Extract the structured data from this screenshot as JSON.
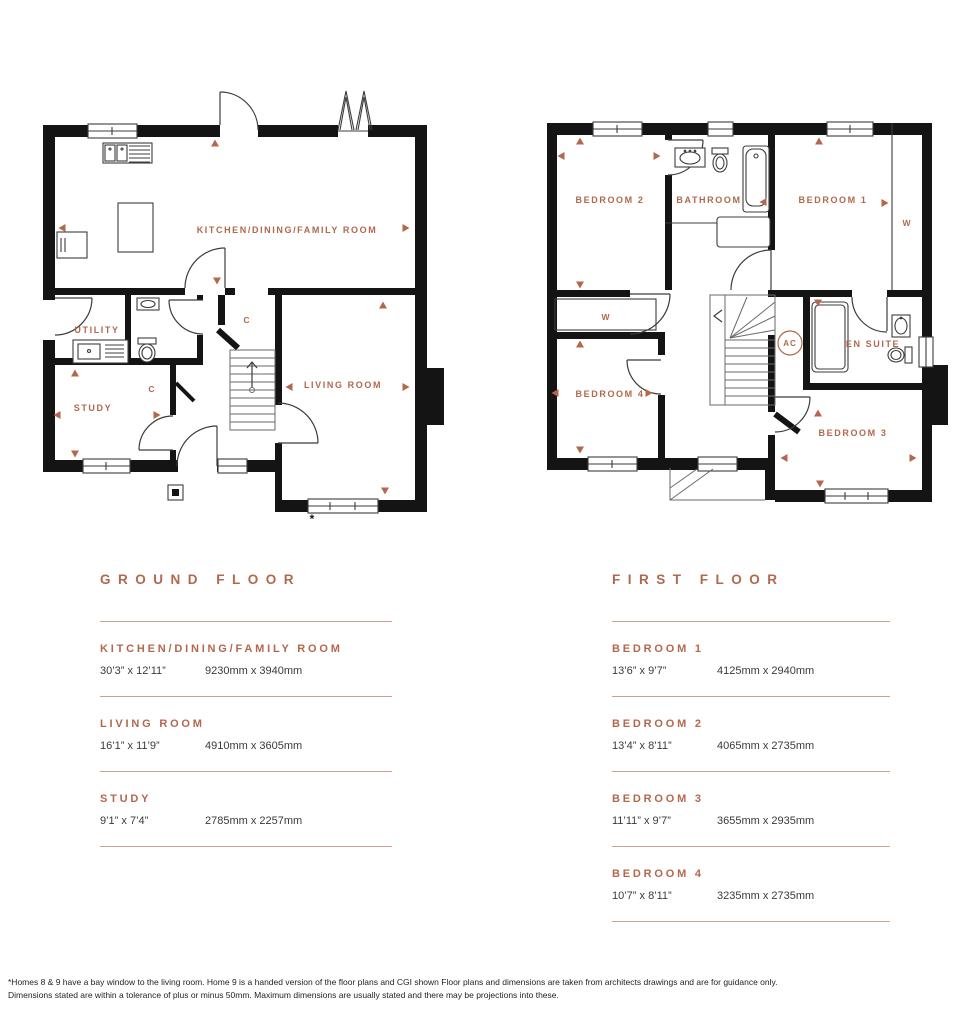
{
  "colors": {
    "accent": "#b2684c",
    "wall": "#141414"
  },
  "ground_plan": {
    "kitchen_label": "KITCHEN/DINING/FAMILY ROOM",
    "utility_label": "UTILITY",
    "study_label": "STUDY",
    "living_label": "LIVING ROOM",
    "cupboard1_label": "C",
    "cupboard2_label": "C",
    "bay_window_marker": "*"
  },
  "first_plan": {
    "bedroom1_label": "BEDROOM 1",
    "bedroom2_label": "BEDROOM 2",
    "bedroom3_label": "BEDROOM 3",
    "bedroom4_label": "BEDROOM 4",
    "bathroom_label": "BATHROOM",
    "ensuite_label": "EN SUITE",
    "wardrobe1_label": "W",
    "wardrobe2_label": "W",
    "ac_label": "AC"
  },
  "schedules": {
    "ground": {
      "title": "GROUND FLOOR",
      "rows": [
        {
          "name": "KITCHEN/DINING/FAMILY ROOM",
          "imperial": "30’3” x 12’11”",
          "metric": "9230mm x 3940mm"
        },
        {
          "name": "LIVING ROOM",
          "imperial": "16’1” x 11’9”",
          "metric": "4910mm x 3605mm"
        },
        {
          "name": "STUDY",
          "imperial": "9’1” x 7’4”",
          "metric": "2785mm x 2257mm"
        }
      ]
    },
    "first": {
      "title": "FIRST FLOOR",
      "rows": [
        {
          "name": "BEDROOM 1",
          "imperial": "13’6” x 9’7”",
          "metric": "4125mm x 2940mm"
        },
        {
          "name": "BEDROOM 2",
          "imperial": "13’4” x 8’11”",
          "metric": "4065mm x 2735mm"
        },
        {
          "name": "BEDROOM 3",
          "imperial": "11’11” x 9’7”",
          "metric": "3655mm x 2935mm"
        },
        {
          "name": "BEDROOM 4",
          "imperial": "10’7” x 8’11”",
          "metric": "3235mm x 2735mm"
        }
      ]
    }
  },
  "footnote": {
    "line1": "*Homes 8 & 9 have a bay window to the living room. Home 9 is a handed version of the floor plans and CGI shown Floor plans and dimensions are taken from architects drawings and are for guidance only.",
    "line2": "Dimensions stated are within a tolerance of plus or minus 50mm. Maximum dimensions are usually stated and there may be projections into these."
  }
}
